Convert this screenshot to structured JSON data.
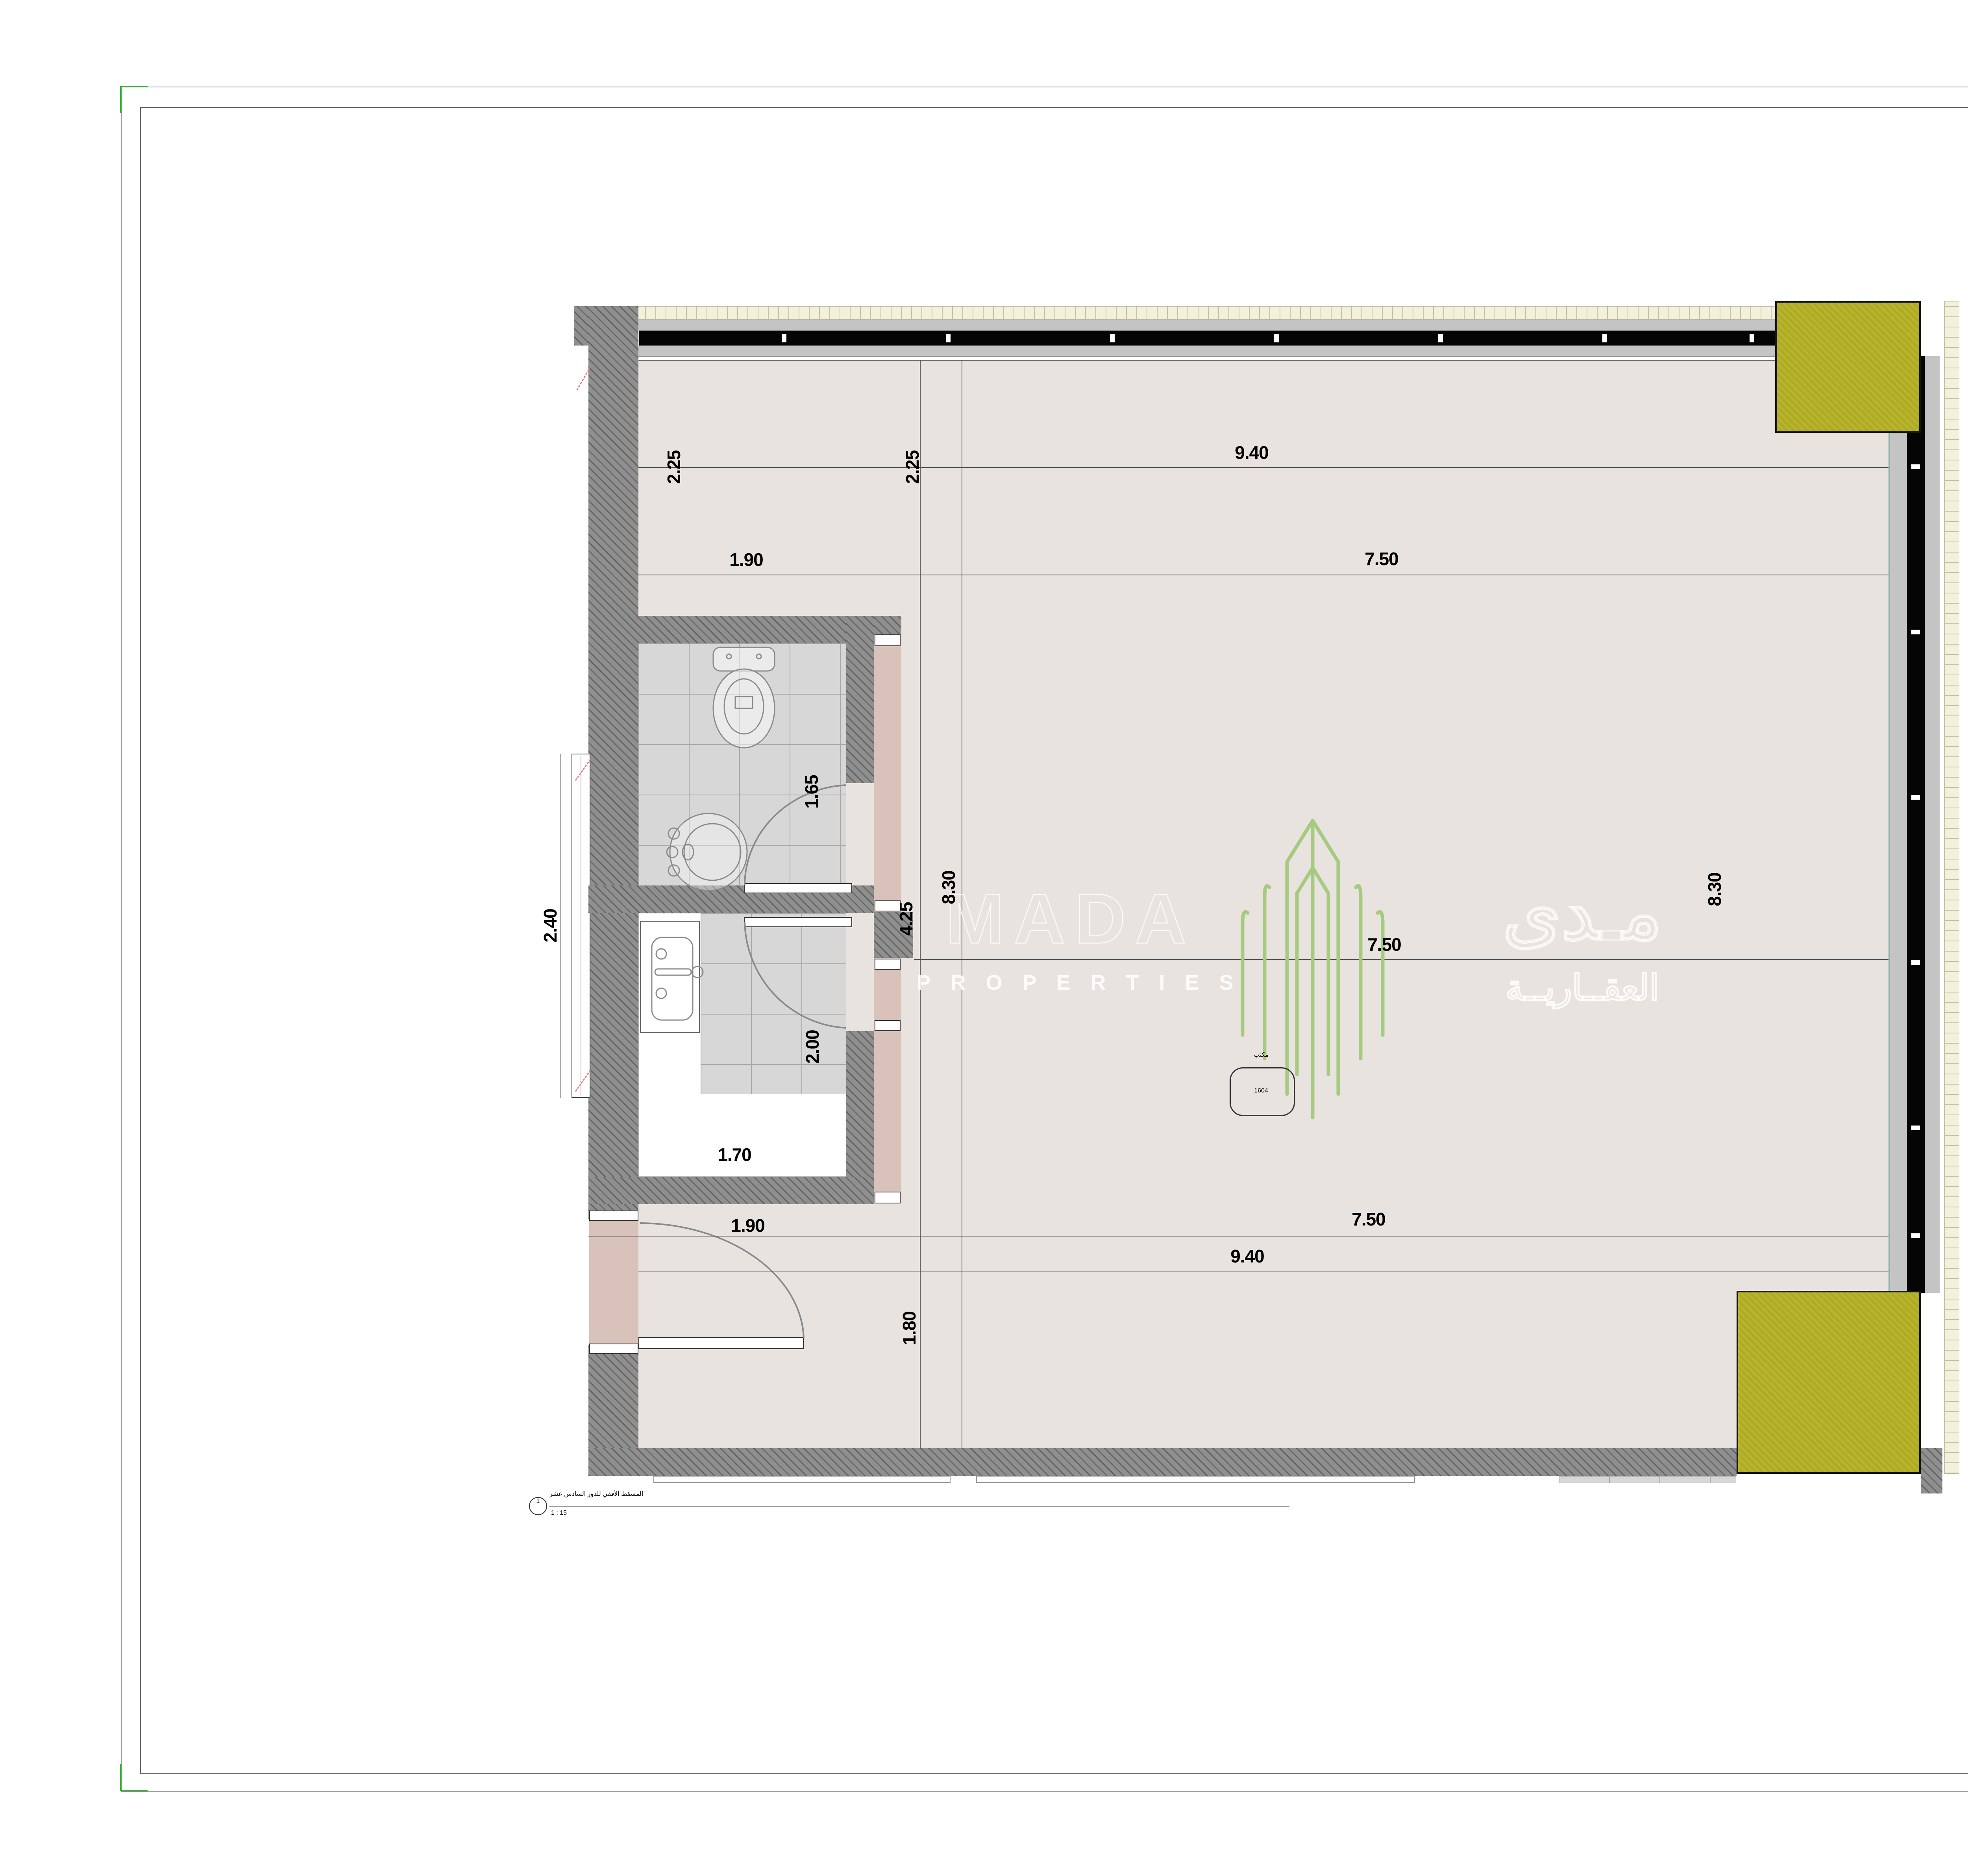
{
  "sheet": {
    "view_title_ar": "المسقط الأفقي للدور السادس عشر",
    "view_scale": "1 : 15",
    "view_number": "1"
  },
  "plan": {
    "room_label_ar": "مكتب",
    "room_number": "1604",
    "dims": {
      "top_len": "9.40",
      "top_left_a": "2.25",
      "top_left_b": "2.25",
      "top_left_w": "1.90",
      "top_sub": "7.50",
      "side_a": "4.25",
      "side_b": "8.30",
      "side_c": "8.30",
      "center": "7.50",
      "win": "2.40",
      "bath": "1.65",
      "kitchen_h": "2.00",
      "kitchen_w": "1.70",
      "bot_left": "1.90",
      "bot_sub": "7.50",
      "bot_len": "9.40",
      "bot_h": "1.80"
    }
  },
  "watermark": {
    "latin": "MADA",
    "latin_sub": "P R O P E R T I E S",
    "arabic": "مـدى",
    "arabic_sub": "العقــاريــة"
  },
  "title_block": {
    "brand": {
      "arabic": "العوالي",
      "latin": "ALAWALY"
    },
    "notes_label": "NOTES :",
    "rega": {
      "name": "REGA",
      "arabic": "الهيئة العامة للعقار",
      "latin": "REAL ESTATE GENERAL AUTHORITY"
    },
    "project_name_label": "PROJECT NAME :",
    "project_name_label_ar": "اسم المشروع:",
    "project_name_line1": "مركز العوالي",
    "project_name_line2": "للأعمال",
    "project_no_label": "PROJECT NO :",
    "client_approval_label": "CLIENT APPROVAL:",
    "client_approval_label_ar": "اسم المالك:",
    "owner_label": "OWNER",
    "drawing_title_label": "DRAWING TITLE:",
    "drawing_title_label_ar": "اسم الصفحة:",
    "rev_header": {
      "rev_no": "REV.NO.",
      "description": "DESCRIPTION",
      "date": "DATE"
    },
    "drawn_by_label": "DRAWN BY :",
    "date_label": "DATE :",
    "date_value": "٠٥/١٩/٢٥",
    "scale_label": "SCALE :",
    "scale_value": "As indicated",
    "drawing_number_label": "DRAWING NUMBER",
    "revision_label": "REVISION",
    "drawing_number_value": "A١٦٠٤",
    "revision_value": "٠"
  },
  "colors": {
    "olive": "#b0ac1f",
    "floor": "#e9e3e0",
    "lobby_pink": "#d8c2ba",
    "wall_gray": "#8f8f8f",
    "curtain_black": "#050505",
    "watermark_green": "#a6cb80",
    "rega_teal": "#2ea99c",
    "rega_navy": "#16395d",
    "border_green": "#2fae2f"
  }
}
